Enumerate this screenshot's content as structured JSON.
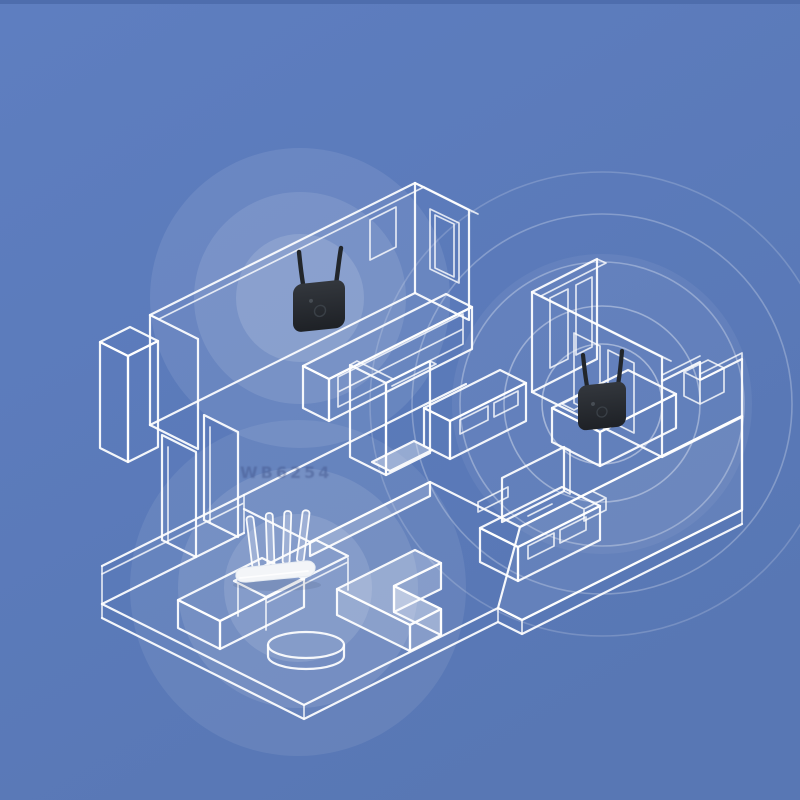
{
  "illustration": {
    "type": "isometric-apartment-wifi-coverage",
    "watermark": "WB6254",
    "colors": {
      "bg": "#5d7cbc",
      "bg-edge": "#4c6cab",
      "line": "#ffffff",
      "ink": "#26292e",
      "antenna": "#22262b",
      "router": "#f3f5f8",
      "sig": "#ffffff"
    },
    "devices": [
      {
        "id": "wifi-extender-1",
        "kind": "wall-plug wifi extender",
        "antennas": 2,
        "room": "living-room-wall"
      },
      {
        "id": "wifi-extender-2",
        "kind": "wall-plug wifi extender",
        "antennas": 2,
        "room": "bedroom-wall"
      },
      {
        "id": "wifi-router",
        "kind": "desktop router",
        "antennas": 4,
        "room": "lounge-desk"
      }
    ],
    "signal_zones": [
      {
        "device": "wifi-extender-1",
        "style": "filled-discs",
        "radii": [
          64,
          106,
          150
        ]
      },
      {
        "device": "wifi-extender-2",
        "style": "rings",
        "radii": [
          60,
          98,
          142,
          190,
          232
        ]
      },
      {
        "device": "wifi-router",
        "style": "filled-discs",
        "radii": [
          74,
          120,
          168
        ]
      }
    ]
  }
}
